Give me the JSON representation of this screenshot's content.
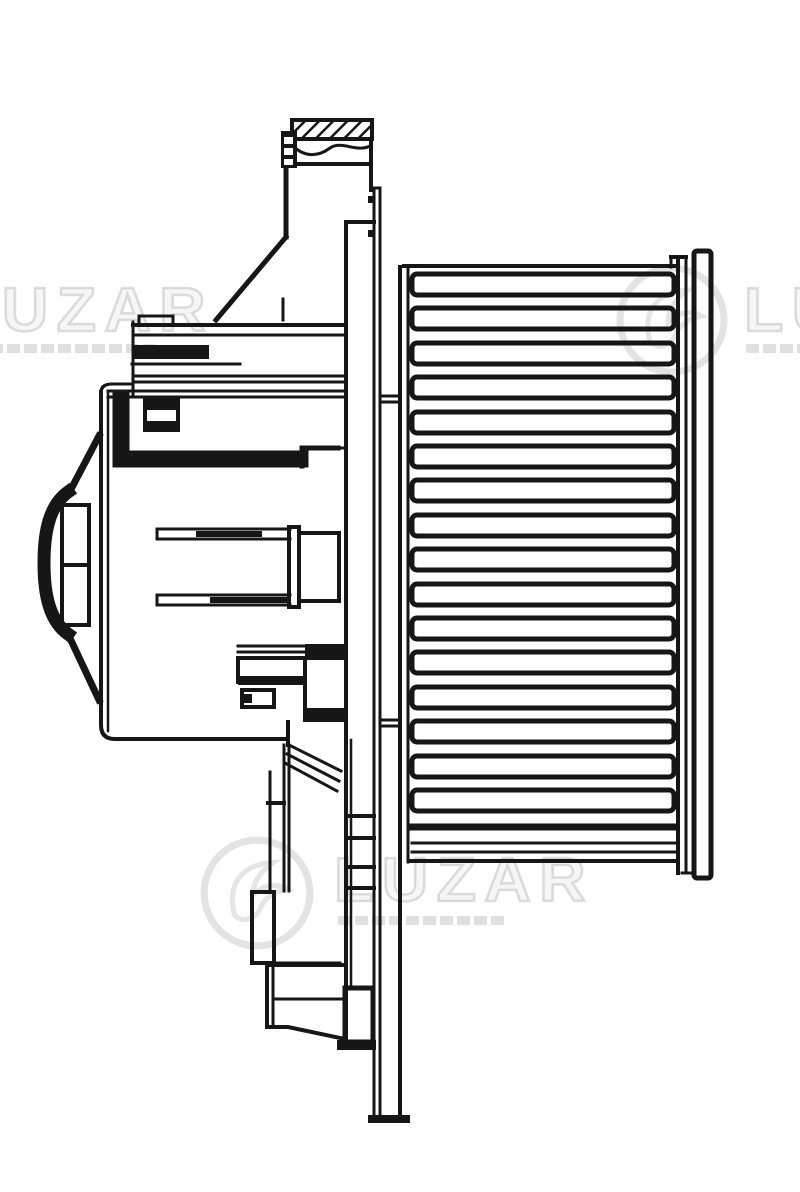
{
  "watermark": {
    "brand": "LUZAR"
  },
  "colors": {
    "paper": "#ffffff",
    "ink": "#161616",
    "watermark_gray": "rgba(0,0,0,0.12)"
  }
}
